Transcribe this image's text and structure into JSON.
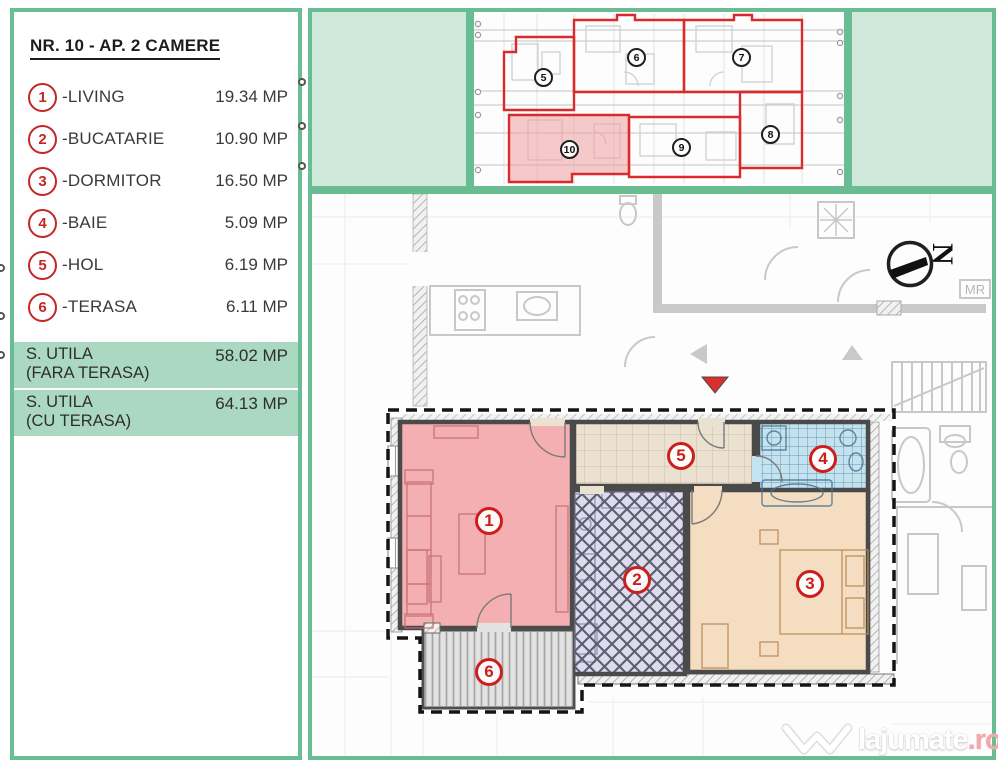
{
  "legend": {
    "title": "NR. 10 - AP. 2 CAMERE",
    "items": [
      {
        "num": "1",
        "label": "-LIVING",
        "area": "19.34 MP"
      },
      {
        "num": "2",
        "label": "-BUCATARIE",
        "area": "10.90 MP"
      },
      {
        "num": "3",
        "label": "-DORMITOR",
        "area": "16.50 MP"
      },
      {
        "num": "4",
        "label": "-BAIE",
        "area": "5.09 MP"
      },
      {
        "num": "5",
        "label": "-HOL",
        "area": "6.19 MP"
      },
      {
        "num": "6",
        "label": "-TERASA",
        "area": "6.11 MP"
      }
    ],
    "summary": [
      {
        "line1": "S. UTILA",
        "line2": "(FARA TERASA)",
        "area": "58.02 MP"
      },
      {
        "line1": "S. UTILA",
        "line2": "(CU TERASA)",
        "area": "64.13 MP"
      }
    ]
  },
  "site_plan": {
    "unit_labels": [
      "5",
      "6",
      "7",
      "8",
      "9",
      "10"
    ],
    "highlighted_unit": "10"
  },
  "plan": {
    "room_labels": [
      "1",
      "2",
      "3",
      "4",
      "5",
      "6"
    ],
    "bg_labels": [
      "MR",
      "MR"
    ]
  },
  "compass": {
    "letter": "N"
  },
  "watermark": {
    "brand": "lajumate",
    "tld": ".ro"
  },
  "colors": {
    "accent_green": "#6abd92",
    "panel_green_fill": "#cfe9db",
    "row_green": "#abd8c1",
    "outline_red": "#d92b2b",
    "living": "#f4afb2",
    "hol": "#eae1d0",
    "baie": "#c3e3f1",
    "bucatarie": "#dcdcee",
    "dormitor": "#f4ddc0",
    "terasa": "#e2e2e2",
    "unit10": "#ef9f9f"
  }
}
